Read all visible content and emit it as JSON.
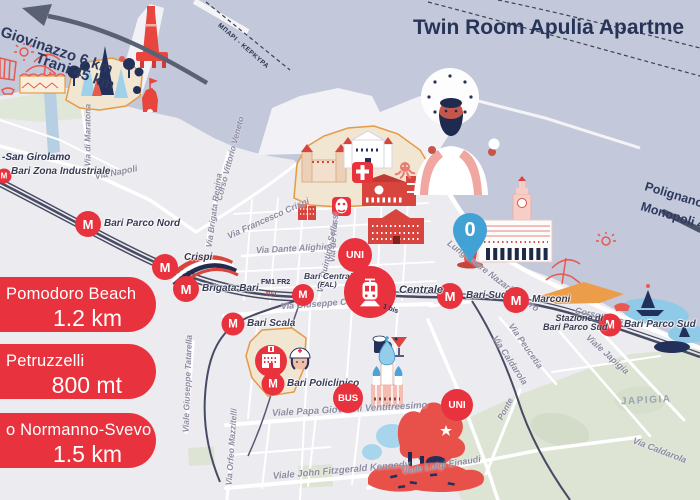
{
  "title": "Twin Room Apulia Apartme",
  "palette": {
    "accent_red": "#e8333f",
    "sea": "#c3c8da",
    "land": "#ecebef",
    "old_town_fill": "#f0e6d2",
    "old_town_outline": "#e59a45",
    "park_green": "#dde4d4",
    "pin_blue": "#42a2d5",
    "title_navy": "#273457",
    "railway": "#474b63"
  },
  "signs": {
    "northwest": {
      "line1": "Giovinazzo 6 km",
      "line2": "Trani 45 km"
    },
    "southeast": {
      "line1": "Polignano",
      "line2": "Monopoli 4"
    }
  },
  "ferry_route_label": "ΜΠΑΡΙ - ΚΕΡΚΥΡΑ",
  "distance_cards": [
    {
      "name": "Pomodoro Beach",
      "distance": "1.2 km"
    },
    {
      "name": "Petruzzelli",
      "distance": "800 mt"
    },
    {
      "name": "o Normanno-Svevo",
      "distance": "1.5 km"
    }
  ],
  "pin": {
    "label": "0"
  },
  "metro": {
    "symbol": "M",
    "stations": [
      {
        "label": "Bari Zona Industriale"
      },
      {
        "label": "Bari Parco Nord"
      },
      {
        "label": "Crispi"
      },
      {
        "label": "Brigata Bari"
      },
      {
        "label": "Bari Centrale",
        "sublabel": "(FAL)"
      },
      {
        "label": "Bari Scala"
      },
      {
        "label": "Bari Policlinico"
      },
      {
        "label": "Bari Sud-Est"
      },
      {
        "label": "Marconi"
      },
      {
        "label": "Bari Parco Sud"
      }
    ]
  },
  "badges": {
    "uni": "UNI",
    "bus": "BUS",
    "train_station_label": "Centrale",
    "train_platform_label": "1 bis",
    "rail_lines_label": "FM1  FR2",
    "rfi_label": "RFI",
    "parco_sud_caption_line1": "Stazione di",
    "parco_sud_caption_line2": "Bari Parco Sud"
  },
  "areas": [
    "-San Girolamo",
    "JAPIGIA"
  ],
  "streets": [
    "Via Napoli",
    "Via di Maratona",
    "Corso Vittorio Veneto",
    "Via Brigata Regina",
    "Via Francesco Crispi",
    "Via Dante Alighieri",
    "Via de Rossi",
    "Via Quintino Sella",
    "Via Giuseppe Capruzzi",
    "Viale Giuseppe Tatarella",
    "Viale Papa Giovanni Ventitreesimo",
    "Viale John Fitzgerald Kennedy",
    "Via Orfeo Mazzitelli",
    "Lungomare Nazario Sauro",
    "Corso Trieste",
    "Via Peucetia",
    "Via Caldarola",
    "Viale Japigia",
    "Via Caldarola",
    "Viale Luigi Einaudi",
    "Ponte"
  ]
}
